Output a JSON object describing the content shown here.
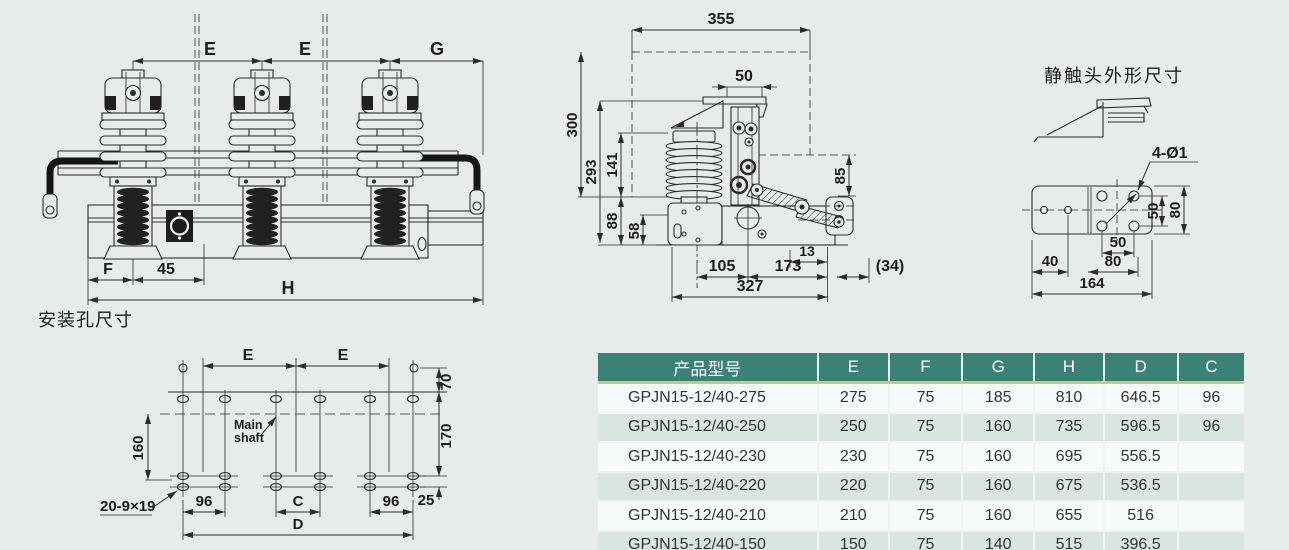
{
  "colors": {
    "page_bg": "#e7ebec",
    "line": "#2b2b2b",
    "table_header_bg": "#3b8276",
    "table_header_text": "#ffffff",
    "table_accent_line": "#d5bd97",
    "table_row_shade": "#d8e5e2"
  },
  "front_view": {
    "dim_e1": "E",
    "dim_e2": "E",
    "dim_g": "G",
    "dim_f": "F",
    "dim_45": "45",
    "dim_h": "H"
  },
  "side_view": {
    "dim_355": "355",
    "dim_50": "50",
    "dim_300": "300",
    "dim_293": "293",
    "dim_141": "141",
    "dim_88": "88",
    "dim_58": "58",
    "dim_85": "85",
    "dim_13": "13",
    "dim_105": "105",
    "dim_173": "173",
    "dim_34": "(34)",
    "dim_327": "327"
  },
  "static_contact": {
    "title": "静触头外形尺寸",
    "dim_holes": "4-Ø1",
    "dim_v50": "50",
    "dim_v80": "80",
    "dim_h50": "50",
    "dim_h80": "80",
    "dim_h40": "40",
    "dim_164": "164"
  },
  "mounting": {
    "title": "安装孔尺寸",
    "dim_e1": "E",
    "dim_e2": "E",
    "dim_70": "70",
    "dim_170": "170",
    "dim_160": "160",
    "dim_25": "25",
    "main_shaft_1": "Main",
    "main_shaft_2": "shaft",
    "label_holes": "20-9×19",
    "dim_96a": "96",
    "dim_c": "C",
    "dim_96b": "96",
    "dim_d": "D"
  },
  "table": {
    "headers": [
      "产品型号",
      "E",
      "F",
      "G",
      "H",
      "D",
      "C"
    ],
    "rows": [
      [
        "GPJN15-12/40-275",
        "275",
        "75",
        "185",
        "810",
        "646.5",
        "96"
      ],
      [
        "GPJN15-12/40-250",
        "250",
        "75",
        "160",
        "735",
        "596.5",
        "96"
      ],
      [
        "GPJN15-12/40-230",
        "230",
        "75",
        "160",
        "695",
        "556.5",
        ""
      ],
      [
        "GPJN15-12/40-220",
        "220",
        "75",
        "160",
        "675",
        "536.5",
        ""
      ],
      [
        "GPJN15-12/40-210",
        "210",
        "75",
        "160",
        "655",
        "516",
        ""
      ],
      [
        "GPJN15-12/40-150",
        "150",
        "75",
        "140",
        "515",
        "396.5",
        ""
      ]
    ]
  }
}
